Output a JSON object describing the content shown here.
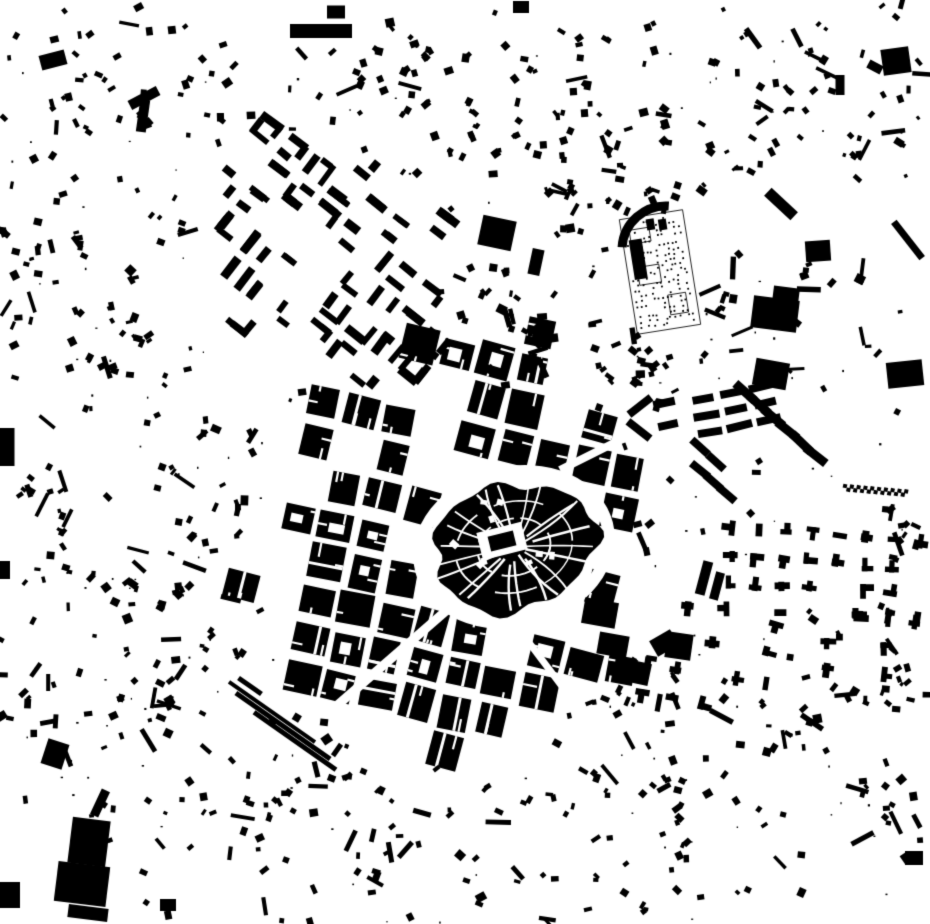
{
  "canvas": {
    "width": 930,
    "height": 924,
    "background": "#ffffff",
    "ink": "#000000"
  },
  "map": {
    "kind": "figure-ground-building-footprint-map",
    "seed": 1337,
    "core": {
      "cx": 514,
      "cy": 547,
      "rx": 82,
      "ry": 63,
      "rot": -14,
      "ring_width": 12,
      "radial_streets": 22,
      "arc_radii": [
        0.45,
        0.72
      ]
    },
    "grids": [
      {
        "name": "ensanche",
        "cx": 450,
        "cy": 552,
        "rot": 13,
        "pitch": 39,
        "street": 7,
        "rx": 200,
        "ry": 235,
        "style": "blocks",
        "avoid_core": true
      },
      {
        "name": "northwest-district",
        "cx": 330,
        "cy": 262,
        "rot": 38,
        "pitch": 33,
        "street": 7,
        "rx": 165,
        "ry": 120,
        "style": "fragments",
        "avoid_core": false
      }
    ],
    "avenues": [
      [
        447,
        610,
        318,
        722,
        9
      ],
      [
        518,
        628,
        604,
        742,
        7
      ],
      [
        560,
        470,
        640,
        430,
        8
      ]
    ],
    "slab_groups": [
      {
        "x": 703,
        "y": 399,
        "rot": -12,
        "rows": 3,
        "row_gap": 17,
        "cols": 3,
        "col_gap": 30,
        "w": 25,
        "h": 8
      },
      {
        "x": 745,
        "y": 392,
        "rot": 42,
        "chain": 6,
        "gap": 19,
        "w": 26,
        "h": 9
      },
      {
        "x": 700,
        "y": 470,
        "rot": 42,
        "chain": 3,
        "gap": 18,
        "w": 22,
        "h": 8
      }
    ],
    "suburbs": [
      {
        "cx": 822,
        "cy": 569,
        "w": 212,
        "h": 96,
        "rot": 4,
        "pitch": 27,
        "p": 0.8
      },
      {
        "cx": 703,
        "cy": 643,
        "w": 132,
        "h": 92,
        "rot": 10,
        "pitch": 30,
        "p": 0.55
      },
      {
        "cx": 872,
        "cy": 641,
        "w": 116,
        "h": 80,
        "rot": 4,
        "pitch": 29,
        "p": 0.5
      }
    ],
    "cemetery": {
      "cx": 660,
      "cy": 272,
      "w": 64,
      "h": 116,
      "rot": -9
    },
    "strips": [
      [
        272,
        712,
        105,
        4,
        35
      ],
      [
        283,
        726,
        115,
        5,
        35
      ],
      [
        295,
        741,
        100,
        5,
        35
      ],
      [
        337,
        750,
        14,
        5,
        125
      ],
      [
        250,
        686,
        28,
        5,
        35
      ]
    ],
    "zigzag": {
      "x": 845,
      "y": 486,
      "n": 19,
      "step": 3.4,
      "amp": 3.5,
      "drift": 0.3,
      "s": 4,
      "rot": 12
    },
    "landmarks": [
      [
        321,
        31,
        62,
        14,
        0
      ],
      [
        336,
        12,
        18,
        13,
        0
      ],
      [
        521,
        7,
        16,
        12,
        0
      ],
      [
        896,
        61,
        28,
        26,
        -8
      ],
      [
        875,
        67,
        15,
        9,
        28
      ],
      [
        896,
        17,
        7,
        5,
        40
      ],
      [
        781,
        204,
        36,
        11,
        43
      ],
      [
        818,
        251,
        25,
        21,
        -4
      ],
      [
        775,
        314,
        46,
        32,
        7
      ],
      [
        786,
        295,
        26,
        16,
        7
      ],
      [
        771,
        374,
        34,
        27,
        10
      ],
      [
        905,
        374,
        36,
        26,
        -6
      ],
      [
        908,
        240,
        46,
        7,
        52
      ],
      [
        7,
        447,
        15,
        38,
        0
      ],
      [
        5,
        570,
        10,
        18,
        0
      ],
      [
        55,
        754,
        22,
        26,
        18
      ],
      [
        89,
        842,
        38,
        46,
        7
      ],
      [
        82,
        884,
        52,
        40,
        7
      ],
      [
        100,
        803,
        9,
        28,
        25
      ],
      [
        168,
        905,
        16,
        12,
        0
      ],
      [
        144,
        98,
        32,
        10,
        -28
      ],
      [
        143,
        116,
        10,
        32,
        8
      ],
      [
        53,
        60,
        26,
        15,
        -15
      ],
      [
        10,
        895,
        20,
        26,
        0
      ],
      [
        88,
        913,
        40,
        13,
        7
      ],
      [
        635,
        672,
        30,
        22,
        12
      ],
      [
        664,
        643,
        24,
        18,
        -30
      ],
      [
        679,
        646,
        26,
        26,
        8
      ],
      [
        914,
        858,
        18,
        14,
        0
      ],
      [
        840,
        85,
        9,
        20,
        0
      ],
      [
        497,
        233,
        34,
        30,
        12
      ],
      [
        536,
        262,
        12,
        26,
        12
      ],
      [
        600,
        613,
        34,
        26,
        10
      ],
      [
        613,
        645,
        30,
        22,
        10
      ],
      [
        704,
        578,
        10,
        34,
        15
      ],
      [
        717,
        586,
        9,
        28,
        15
      ],
      [
        640,
        406,
        28,
        8,
        -38
      ],
      [
        639,
        430,
        28,
        8,
        38
      ],
      [
        664,
        403,
        22,
        8,
        -12
      ],
      [
        668,
        425,
        20,
        8,
        -12
      ],
      [
        700,
        447,
        22,
        8,
        42
      ],
      [
        716,
        462,
        22,
        8,
        42
      ]
    ],
    "clusters": [
      [
        52,
        236,
        55,
        16
      ],
      [
        130,
        330,
        65,
        14
      ],
      [
        185,
        650,
        85,
        26
      ],
      [
        660,
        735,
        85,
        24
      ],
      [
        770,
        705,
        55,
        12
      ],
      [
        310,
        838,
        85,
        16
      ],
      [
        565,
        122,
        70,
        16
      ],
      [
        705,
        122,
        80,
        12
      ],
      [
        850,
        655,
        60,
        14
      ],
      [
        885,
        815,
        55,
        10
      ],
      [
        490,
        855,
        95,
        14
      ],
      [
        205,
        488,
        75,
        18
      ],
      [
        95,
        555,
        55,
        10
      ],
      [
        430,
        85,
        60,
        10
      ],
      [
        190,
        85,
        60,
        12
      ],
      [
        845,
        305,
        65,
        8
      ],
      [
        878,
        525,
        45,
        8
      ],
      [
        655,
        845,
        65,
        10
      ],
      [
        95,
        128,
        55,
        8
      ],
      [
        615,
        345,
        45,
        10
      ],
      [
        530,
        350,
        45,
        12
      ],
      [
        480,
        300,
        45,
        10
      ],
      [
        660,
        365,
        40,
        10
      ],
      [
        30,
        700,
        40,
        8
      ],
      [
        760,
        130,
        50,
        8
      ],
      [
        370,
        55,
        45,
        8
      ],
      [
        620,
        40,
        45,
        6
      ],
      [
        775,
        45,
        45,
        6
      ],
      [
        240,
        770,
        60,
        10
      ],
      [
        350,
        790,
        60,
        8
      ],
      [
        120,
        700,
        50,
        8
      ],
      [
        40,
        480,
        40,
        8
      ],
      [
        905,
        690,
        30,
        6
      ],
      [
        870,
        120,
        40,
        6
      ],
      [
        640,
        180,
        40,
        8
      ],
      [
        580,
        200,
        40,
        8
      ],
      [
        480,
        140,
        45,
        8
      ],
      [
        725,
        275,
        35,
        6
      ]
    ],
    "scatter": {
      "count": 400,
      "specks": 160
    }
  }
}
